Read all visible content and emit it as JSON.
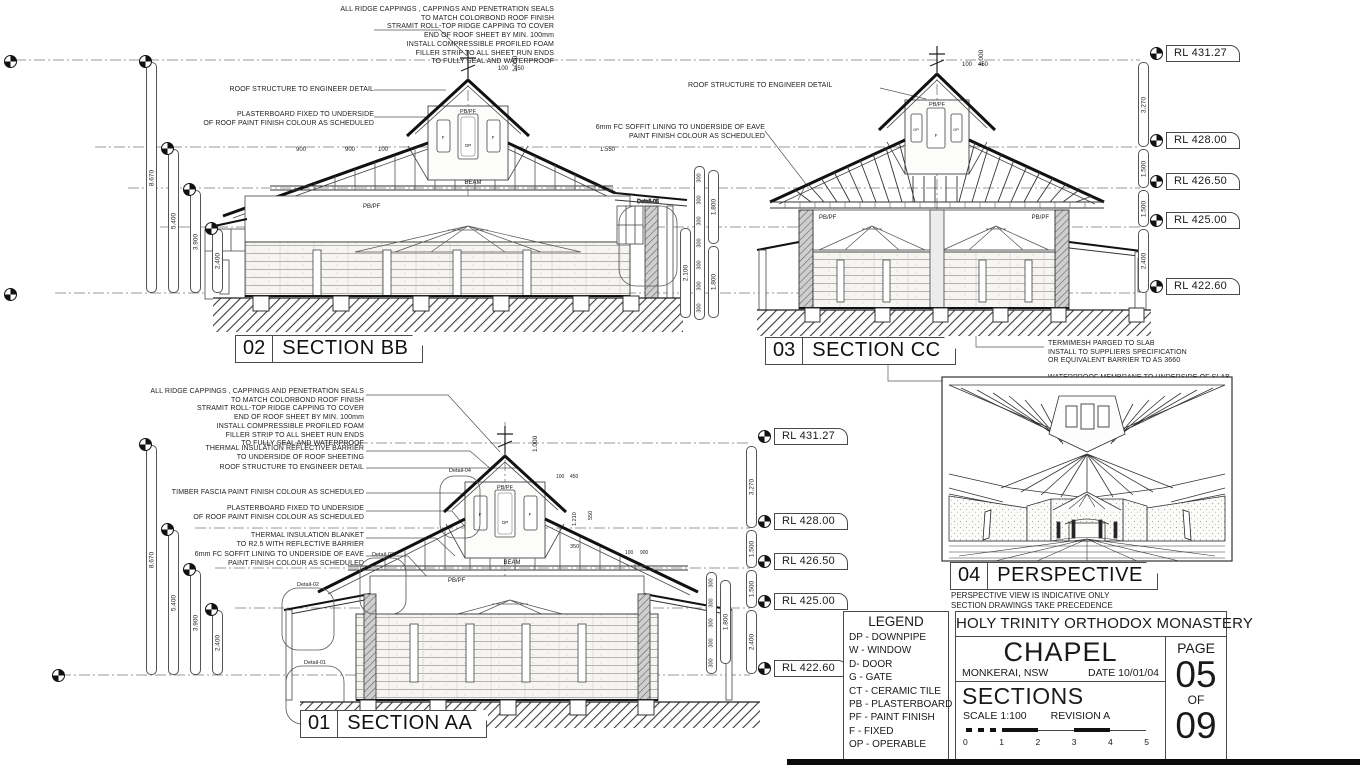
{
  "sections": {
    "bb": {
      "num": "02",
      "title": "SECTION BB"
    },
    "cc": {
      "num": "03",
      "title": "SECTION CC"
    },
    "aa": {
      "num": "01",
      "title": "SECTION AA"
    },
    "perspective": {
      "num": "04",
      "title": "PERSPECTIVE",
      "notes": [
        "PERSPECTIVE VIEW IS INDICATIVE ONLY",
        "SECTION DRAWINGS TAKE PRECEDENCE"
      ]
    }
  },
  "notes": {
    "ridge": [
      "ALL RIDGE CAPPINGS , CAPPINGS AND PENETRATION SEALS",
      "TO MATCH COLORBOND ROOF FINISH",
      "STRAMIT ROLL-TOP RIDGE CAPPING TO COVER",
      "END OF ROOF SHEET BY MIN. 100mm",
      "INSTALL COMPRESSIBLE PROFILED FOAM",
      "FILLER STRIP TO ALL SHEET RUN ENDS",
      "TO FULLY SEAL AND WATERPROOF"
    ],
    "roof_structure": "ROOF STRUCTURE TO ENGINEER DETAIL",
    "plasterboard": [
      "PLASTERBOARD FIXED TO UNDERSIDE",
      "OF ROOF PAINT FINISH COLOUR AS SCHEDULED"
    ],
    "soffit": [
      "6mm FC SOFFIT LINING TO UNDERSIDE OF EAVE",
      "PAINT FINISH COLOUR AS SCHEDULED"
    ],
    "termimesh": [
      "TERMIMESH PARGED TO SLAB",
      "INSTALL TO SUPPLIERS SPECIFICATION",
      "OR EQUIVALENT BARRIER TO AS 3660"
    ],
    "waterproof": [
      "WATERPROOF MEMBRANE TO UNDERSIDE OF SLAB",
      "COURSE GRANULAR BACKFILL UNDER SLAB",
      "TO ENGINEER SPECIFICATION"
    ],
    "thermal_reflective": [
      "THERMAL INSULATION REFLECTIVE BARRIER",
      "TO UNDERSIDE OF ROOF SHEETING"
    ],
    "timber_fascia": "TIMBER FASCIA PAINT FINISH COLOUR AS SCHEDULED",
    "thermal_blanket": [
      "THERMAL INSULATION BLANKET",
      "TO R2.5 WITH REFLECTIVE BARRIER"
    ]
  },
  "levels": {
    "rl": [
      "RL 431.27",
      "RL 428.00",
      "RL 426.50",
      "RL 425.00",
      "RL 422.60"
    ],
    "spacings": [
      "3.270",
      "1.500",
      "1.500",
      "2.400"
    ]
  },
  "dims": {
    "bb_left": [
      "8.670",
      "5.400",
      "3.900",
      "2.400"
    ],
    "aa_left": [
      "8.670",
      "5.400",
      "3.900",
      "2.400"
    ],
    "stack300": "300",
    "d1800": "1.800",
    "d2100": "2.100",
    "d1000": "1.000",
    "d100": "100",
    "d450": "450",
    "d900": "900",
    "d1550": "1.550",
    "d350": "350",
    "d550": "550",
    "d1210": "1.210"
  },
  "labels": {
    "pbpf": "PB/PF",
    "beam": "BEAM",
    "f": "F",
    "op": "OP",
    "d01": "Detail-01",
    "d02": "Detail-02",
    "d03": "Detail-03",
    "d04": "Detail-04",
    "d05": "Detail-05"
  },
  "legend": {
    "title": "LEGEND",
    "items": [
      "DP - DOWNPIPE",
      "W - WINDOW",
      "D- DOOR",
      "G - GATE",
      "CT - CERAMIC TILE",
      "PB - PLASTERBOARD",
      "PF - PAINT FINISH",
      "F - FIXED",
      "OP - OPERABLE"
    ]
  },
  "titleblock": {
    "org": "HOLY TRINITY ORTHODOX MONASTERY",
    "project": "CHAPEL",
    "location": "MONKERAI, NSW",
    "date": "DATE 10/01/04",
    "sheet_name": "SECTIONS",
    "scale": "SCALE 1:100",
    "revision": "REVISION A",
    "page_label": "PAGE",
    "page_no": "05",
    "of_label": "OF",
    "page_total": "09",
    "scalebar_ticks": [
      "0",
      "1",
      "2",
      "3",
      "4",
      "5"
    ]
  }
}
